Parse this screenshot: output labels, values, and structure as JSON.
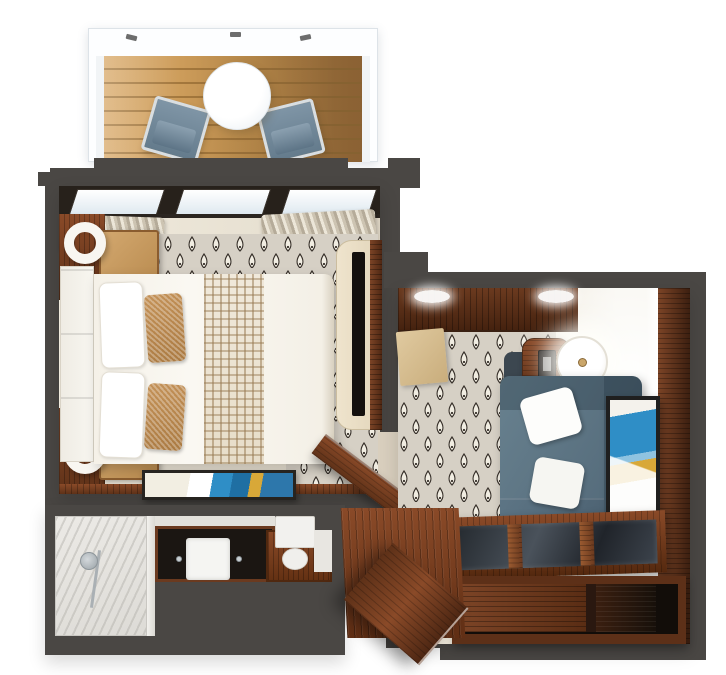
{
  "title": "Suite floor plan 3D render",
  "colors": {
    "wall": "#4a4744",
    "cream": "#eae3d6",
    "carpet_base": "#d6d0c5",
    "motif_fill": "#f1ede2",
    "motif_stroke": "#37302a",
    "deck": "#c3924f",
    "deck_gap": "#a3773c",
    "wood": "#7c4426",
    "wood_dark": "#5e3118",
    "tan": "#c49258",
    "slate": "#68818f",
    "chair": "#7f95a6",
    "glass": "#e3edf3",
    "tv": "#14100d",
    "art_blue": "#2f8ec6",
    "art_gold": "#d8a838",
    "marble": "#dddbd6",
    "white": "#ffffff"
  },
  "scene": {
    "rooms": [
      {
        "id": "balcony",
        "label": "Balcony",
        "items": [
          "white railing",
          "teak plank deck",
          "round white table",
          "two blue lounge chairs"
        ]
      },
      {
        "id": "bedroom",
        "label": "Bedroom",
        "items": [
          "sliding glass doors to balcony",
          "bunched curtains both sides",
          "bed with white duvet and plaid runner",
          "white upholstered headboard",
          "two wood nightstands",
          "two white sculptural lamps",
          "ikat teardrop rug",
          "cream wall unit with TV",
          "framed blue-gold artwork on console",
          "open interior door"
        ]
      },
      {
        "id": "living_room",
        "label": "Living room",
        "items": [
          "dark wood credenza",
          "two ceiling lights",
          "tan bench",
          "rounded wood desk with lamp",
          "desk chair",
          "slate-blue sofa with two white pillows",
          "ikat teardrop rug",
          "glass-top wood coffee table",
          "dark wood media cabinet",
          "leaning blue-gold artwork",
          "wood paneled wall"
        ]
      },
      {
        "id": "bathroom",
        "label": "Bathroom",
        "items": [
          "marble walk-in shower with handheld fixture",
          "dark vanity counter with white sink",
          "toilet with tank"
        ]
      },
      {
        "id": "entry",
        "label": "Entry",
        "items": [
          "wood plank floor",
          "open entrance door"
        ]
      }
    ]
  }
}
